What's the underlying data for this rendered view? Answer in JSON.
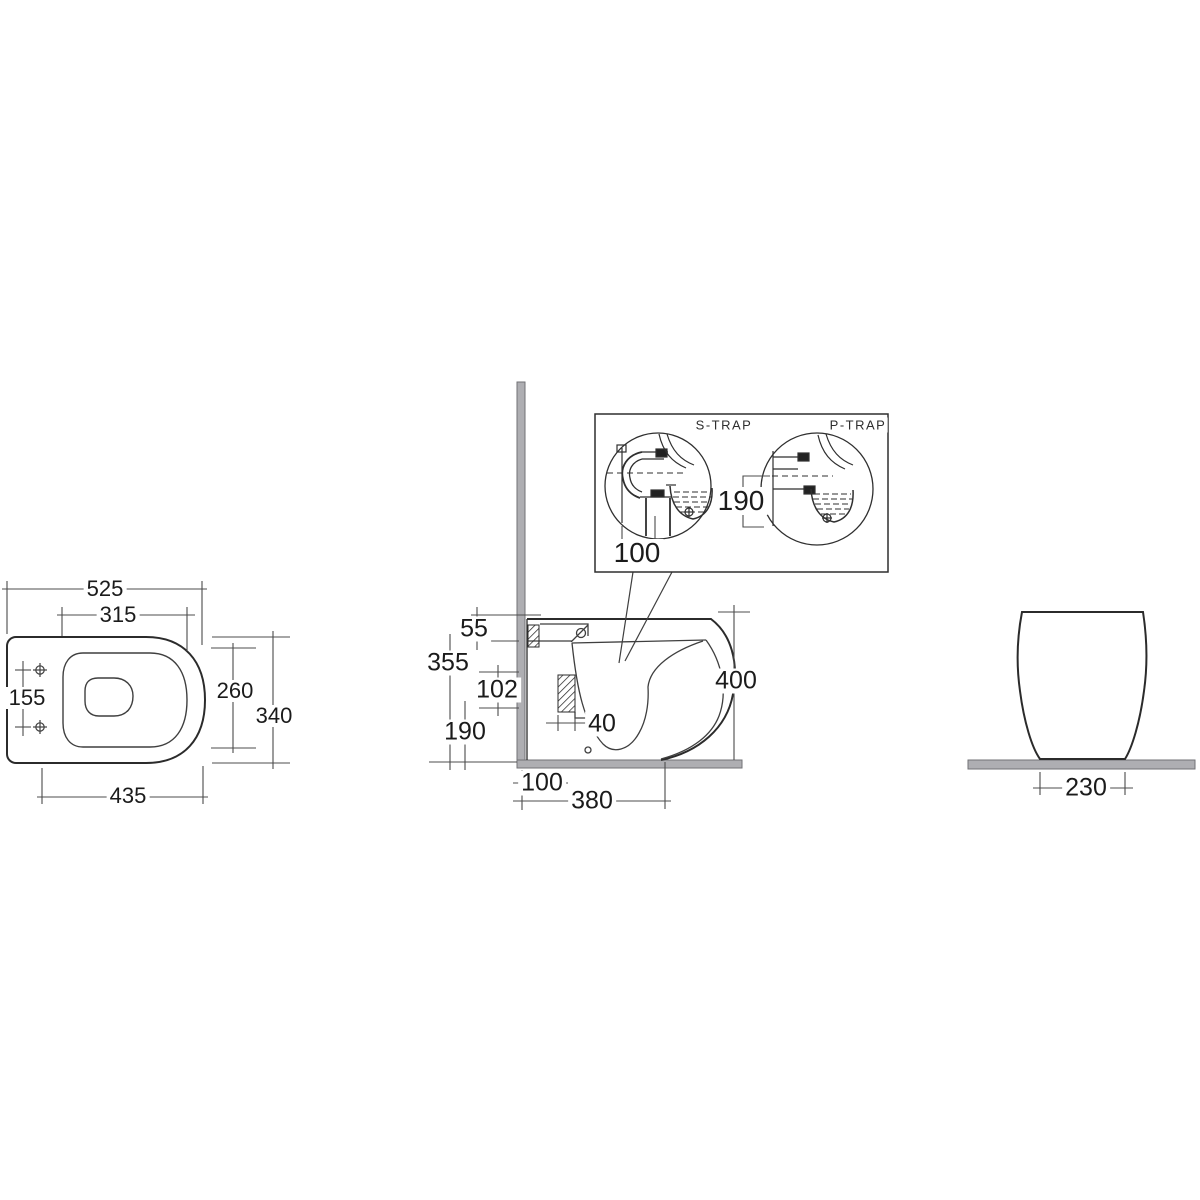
{
  "diagram": {
    "type": "technical-dimension-drawing",
    "subject": "back-to-wall toilet pan, three orthographic views with trap detail inset",
    "colors": {
      "background": "#ffffff",
      "outline": "#2b2b2b",
      "thin_line": "#3f3f3f",
      "dimension_line": "#4c4c4c",
      "wall_floor_fill": "#aeaeb2",
      "wall_floor_stroke": "#727276",
      "text": "#1b1b1b"
    },
    "plan_view": {
      "overall_length": "525",
      "cutout_length": "315",
      "fixing_centres": "155",
      "cutout_width": "260",
      "overall_width": "340",
      "base_length": "435"
    },
    "side_view": {
      "rim_section": "55",
      "underside_height": "355",
      "outlet_spacing": "102",
      "outlet_height": "190",
      "outlet_depth": "40",
      "overall_height": "400",
      "outlet_setout": "100",
      "base_depth": "380"
    },
    "trap_inset": {
      "s_trap_label": "S-TRAP",
      "p_trap_label": "P-TRAP",
      "s_trap_setout": "100",
      "p_trap_height": "190"
    },
    "front_view": {
      "base_width": "230"
    }
  }
}
